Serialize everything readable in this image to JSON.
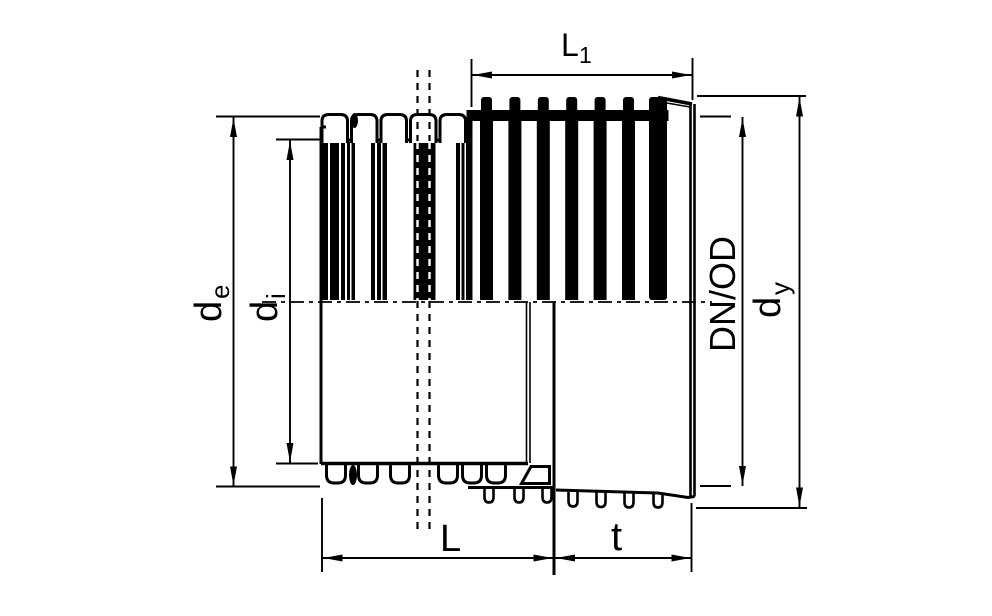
{
  "labels": {
    "l1": {
      "base": "L",
      "sub": "1"
    },
    "de": {
      "base": "d",
      "sub": "e"
    },
    "di": {
      "base": "d",
      "sub": "i"
    },
    "dnod": {
      "text": "DN/OD"
    },
    "dy": {
      "base": "d",
      "sub": "y"
    },
    "l": {
      "text": "L"
    },
    "t": {
      "text": "t"
    }
  },
  "colors": {
    "line": "#000000",
    "background": "#ffffff"
  }
}
